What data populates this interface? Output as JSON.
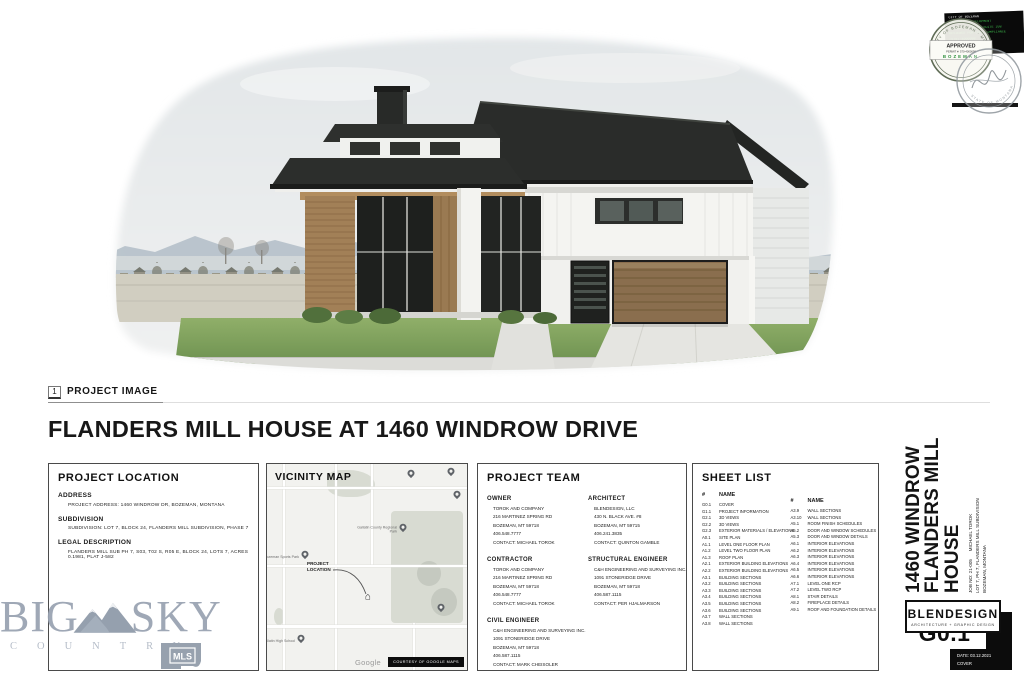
{
  "figure": {
    "number": "1",
    "label": "PROJECT IMAGE"
  },
  "main_title": "FLANDERS MILL HOUSE AT 1460 WINDROW DRIVE",
  "project_location": {
    "heading": "PROJECT LOCATION",
    "sections": [
      {
        "label": "ADDRESS",
        "text": "PROJECT ADDRESS: 1460 WINDROW DR, BOZEMAN, MONTANA"
      },
      {
        "label": "SUBDIVISION",
        "text": "SUBDIVISION: LOT 7, BLOCK 24, FLANDERS MILL SUBDIVISION, PHASE 7"
      },
      {
        "label": "LEGAL DESCRIPTION",
        "text": "FLANDERS MILL SUB PH 7, S03, T02 S, R05 E, BLOCK 24, LOTS 7, ACRES 0.1981, PLAT J-582"
      }
    ]
  },
  "vicinity_map": {
    "heading": "VICINITY MAP",
    "project_location_label": "PROJECT LOCATION",
    "google_label": "Google",
    "courtesy_label": "COURTESY OF GOOGLE MAPS",
    "pins": [
      {
        "label": "Gallatin County Regional Park",
        "x": 68,
        "y": 32
      },
      {
        "label": "Bozeman Sports Park",
        "x": 19,
        "y": 45
      },
      {
        "label": "Gallatin High School",
        "x": 17,
        "y": 86
      },
      {
        "label": "",
        "x": 87,
        "y": 71
      },
      {
        "label": "",
        "x": 92,
        "y": 5
      },
      {
        "label": "",
        "x": 95,
        "y": 16
      },
      {
        "label": "",
        "x": 72,
        "y": 6
      }
    ]
  },
  "project_team": {
    "heading": "PROJECT TEAM",
    "columns": [
      {
        "groups": [
          {
            "role": "OWNER",
            "lines": [
              "TOROK AND COMPANY",
              "216 MARTINEZ SPRING RD",
              "BOZEMAN, MT 59718",
              "406.548.7777",
              "CONTACT: MICHAEL TOROK"
            ]
          },
          {
            "role": "CONTRACTOR",
            "lines": [
              "TOROK AND COMPANY",
              "216 MARTINEZ SPRING RD",
              "BOZEMAN, MT 59718",
              "406.548.7777",
              "CONTACT: MICHAEL TOROK"
            ]
          },
          {
            "role": "CIVIL ENGINEER",
            "lines": [
              "C&H ENGINEERING AND SURVEYING INC.",
              "1091 STONERIDGE DRIVE",
              "BOZEMAN, MT 59718",
              "406.587.1115",
              "CONTACT: MARK CHEISOLER"
            ]
          }
        ]
      },
      {
        "groups": [
          {
            "role": "ARCHITECT",
            "lines": [
              "BLENDESIGN, LLC",
              "430 N. BLACK AVE. #8",
              "BOZEMAN, MT 59715",
              "406.241.3835",
              "CONTACT: QUINTON GAMBLE"
            ]
          },
          {
            "role": "STRUCTURAL ENGINEER",
            "lines": [
              "C&H ENGINEERING AND SURVEYING INC.",
              "1091 STONERIDGE DRIVE",
              "BOZEMAN, MT 59718",
              "406.587.1115",
              "CONTACT: PER HJALMARSON"
            ]
          }
        ]
      }
    ]
  },
  "sheet_list": {
    "heading": "SHEET LIST",
    "number_header": "#",
    "name_header": "NAME",
    "columns": [
      {
        "rows": [
          {
            "num": "G0.1",
            "name": "COVER"
          },
          {
            "num": "G1.1",
            "name": "PROJECT INFORMATION"
          },
          {
            "num": "G2.1",
            "name": "3D VIEWS"
          },
          {
            "num": "G2.2",
            "name": "3D VIEWS"
          },
          {
            "num": "G2.3",
            "name": "EXTERIOR MATERIALS / ELEVATIONS"
          },
          {
            "num": "A0.1",
            "name": "SITE PLAN"
          },
          {
            "num": "A1.1",
            "name": "LEVEL ONE FLOOR PLAN"
          },
          {
            "num": "A1.2",
            "name": "LEVEL TWO FLOOR PLAN"
          },
          {
            "num": "A1.3",
            "name": "ROOF PLAN"
          },
          {
            "num": "A2.1",
            "name": "EXTERIOR BUILDING ELEVATIONS"
          },
          {
            "num": "A2.2",
            "name": "EXTERIOR BUILDING ELEVATIONS"
          },
          {
            "num": "A3.1",
            "name": "BUILDING SECTIONS"
          },
          {
            "num": "A3.2",
            "name": "BUILDING SECTIONS"
          },
          {
            "num": "A3.3",
            "name": "BUILDING SECTIONS"
          },
          {
            "num": "A3.4",
            "name": "BUILDING SECTIONS"
          },
          {
            "num": "A3.5",
            "name": "BUILDING SECTIONS"
          },
          {
            "num": "A3.6",
            "name": "BUILDING SECTIONS"
          },
          {
            "num": "A3.7",
            "name": "WALL SECTIONS"
          },
          {
            "num": "A3.8",
            "name": "WALL SECTIONS"
          }
        ]
      },
      {
        "rows": [
          {
            "num": "A3.9",
            "name": "WALL SECTIONS"
          },
          {
            "num": "A3.10",
            "name": "WALL SECTIONS"
          },
          {
            "num": "A5.1",
            "name": "ROOM FINISH SCHEDULES"
          },
          {
            "num": "A5.2",
            "name": "DOOR AND WINDOW SCHEDULES"
          },
          {
            "num": "A5.3",
            "name": "DOOR AND WINDOW DETAILS"
          },
          {
            "num": "A6.1",
            "name": "INTERIOR ELEVATIONS"
          },
          {
            "num": "A6.2",
            "name": "INTERIOR ELEVATIONS"
          },
          {
            "num": "A6.3",
            "name": "INTERIOR ELEVATIONS"
          },
          {
            "num": "A6.4",
            "name": "INTERIOR ELEVATIONS"
          },
          {
            "num": "A6.5",
            "name": "INTERIOR ELEVATIONS"
          },
          {
            "num": "A6.6",
            "name": "INTERIOR ELEVATIONS"
          },
          {
            "num": "A7.1",
            "name": "LEVEL ONE RCP"
          },
          {
            "num": "A7.2",
            "name": "LEVEL TWO RCP"
          },
          {
            "num": "A8.1",
            "name": "STAIR DETAILS"
          },
          {
            "num": "A8.2",
            "name": "FIREPLACE DETAILS"
          },
          {
            "num": "A9.1",
            "name": "ROOF AND FOUNDATION DETAILS"
          }
        ]
      }
    ]
  },
  "titleblock": {
    "project_title_lines": [
      "1460 WINDROW",
      "FLANDERS MILL",
      "HOUSE"
    ],
    "job_info_lines": [
      "JOB NO: 21-005      MICHAEL TOROK",
      "LOT 7, PH 7, FLANDERS MILL SUBDIVISION",
      "BOZEMAN, MONTANA"
    ],
    "firm_name": "BLENDESIGN",
    "firm_tagline": "ARCHITECTURE + GRAPHIC DESIGN",
    "sheet_number": "G0.1",
    "sheet_date": "DATE: 03.12.2021",
    "sheet_name": "COVER"
  },
  "watermark": {
    "word1": "BIG",
    "word2": "SKY",
    "word3": "COUNTRY",
    "badge": "MLS"
  },
  "stamps": {
    "digital_lines": [
      "CITY OF BOZEMAN",
      "COMMUNITY DEVELOPMENT",
      "20 EAST OLIVE ST SUITE 208",
      "REVIEWED FOR CODE COMPLIANCE",
      "(570)-4000098"
    ],
    "approved": {
      "arc_text": "CITY OF BOZEMAN · MONTANA ·",
      "line1": "APPROVED",
      "line2": "PERMIT #: 570-4000098",
      "line3": "BOZEMAN"
    },
    "seal_arc_text": "STATE OF MONTANA"
  },
  "colors": {
    "stamp_green": "#3cb54a",
    "seal_gray": "#8f979c",
    "watermark_gray": "#98a2b1",
    "roof_dark": "#2b2d2b",
    "siding_white": "#f4f4f1",
    "wood": "#8a6e4e",
    "grass": "#7da35c",
    "mountain": "#b7c2ca"
  }
}
